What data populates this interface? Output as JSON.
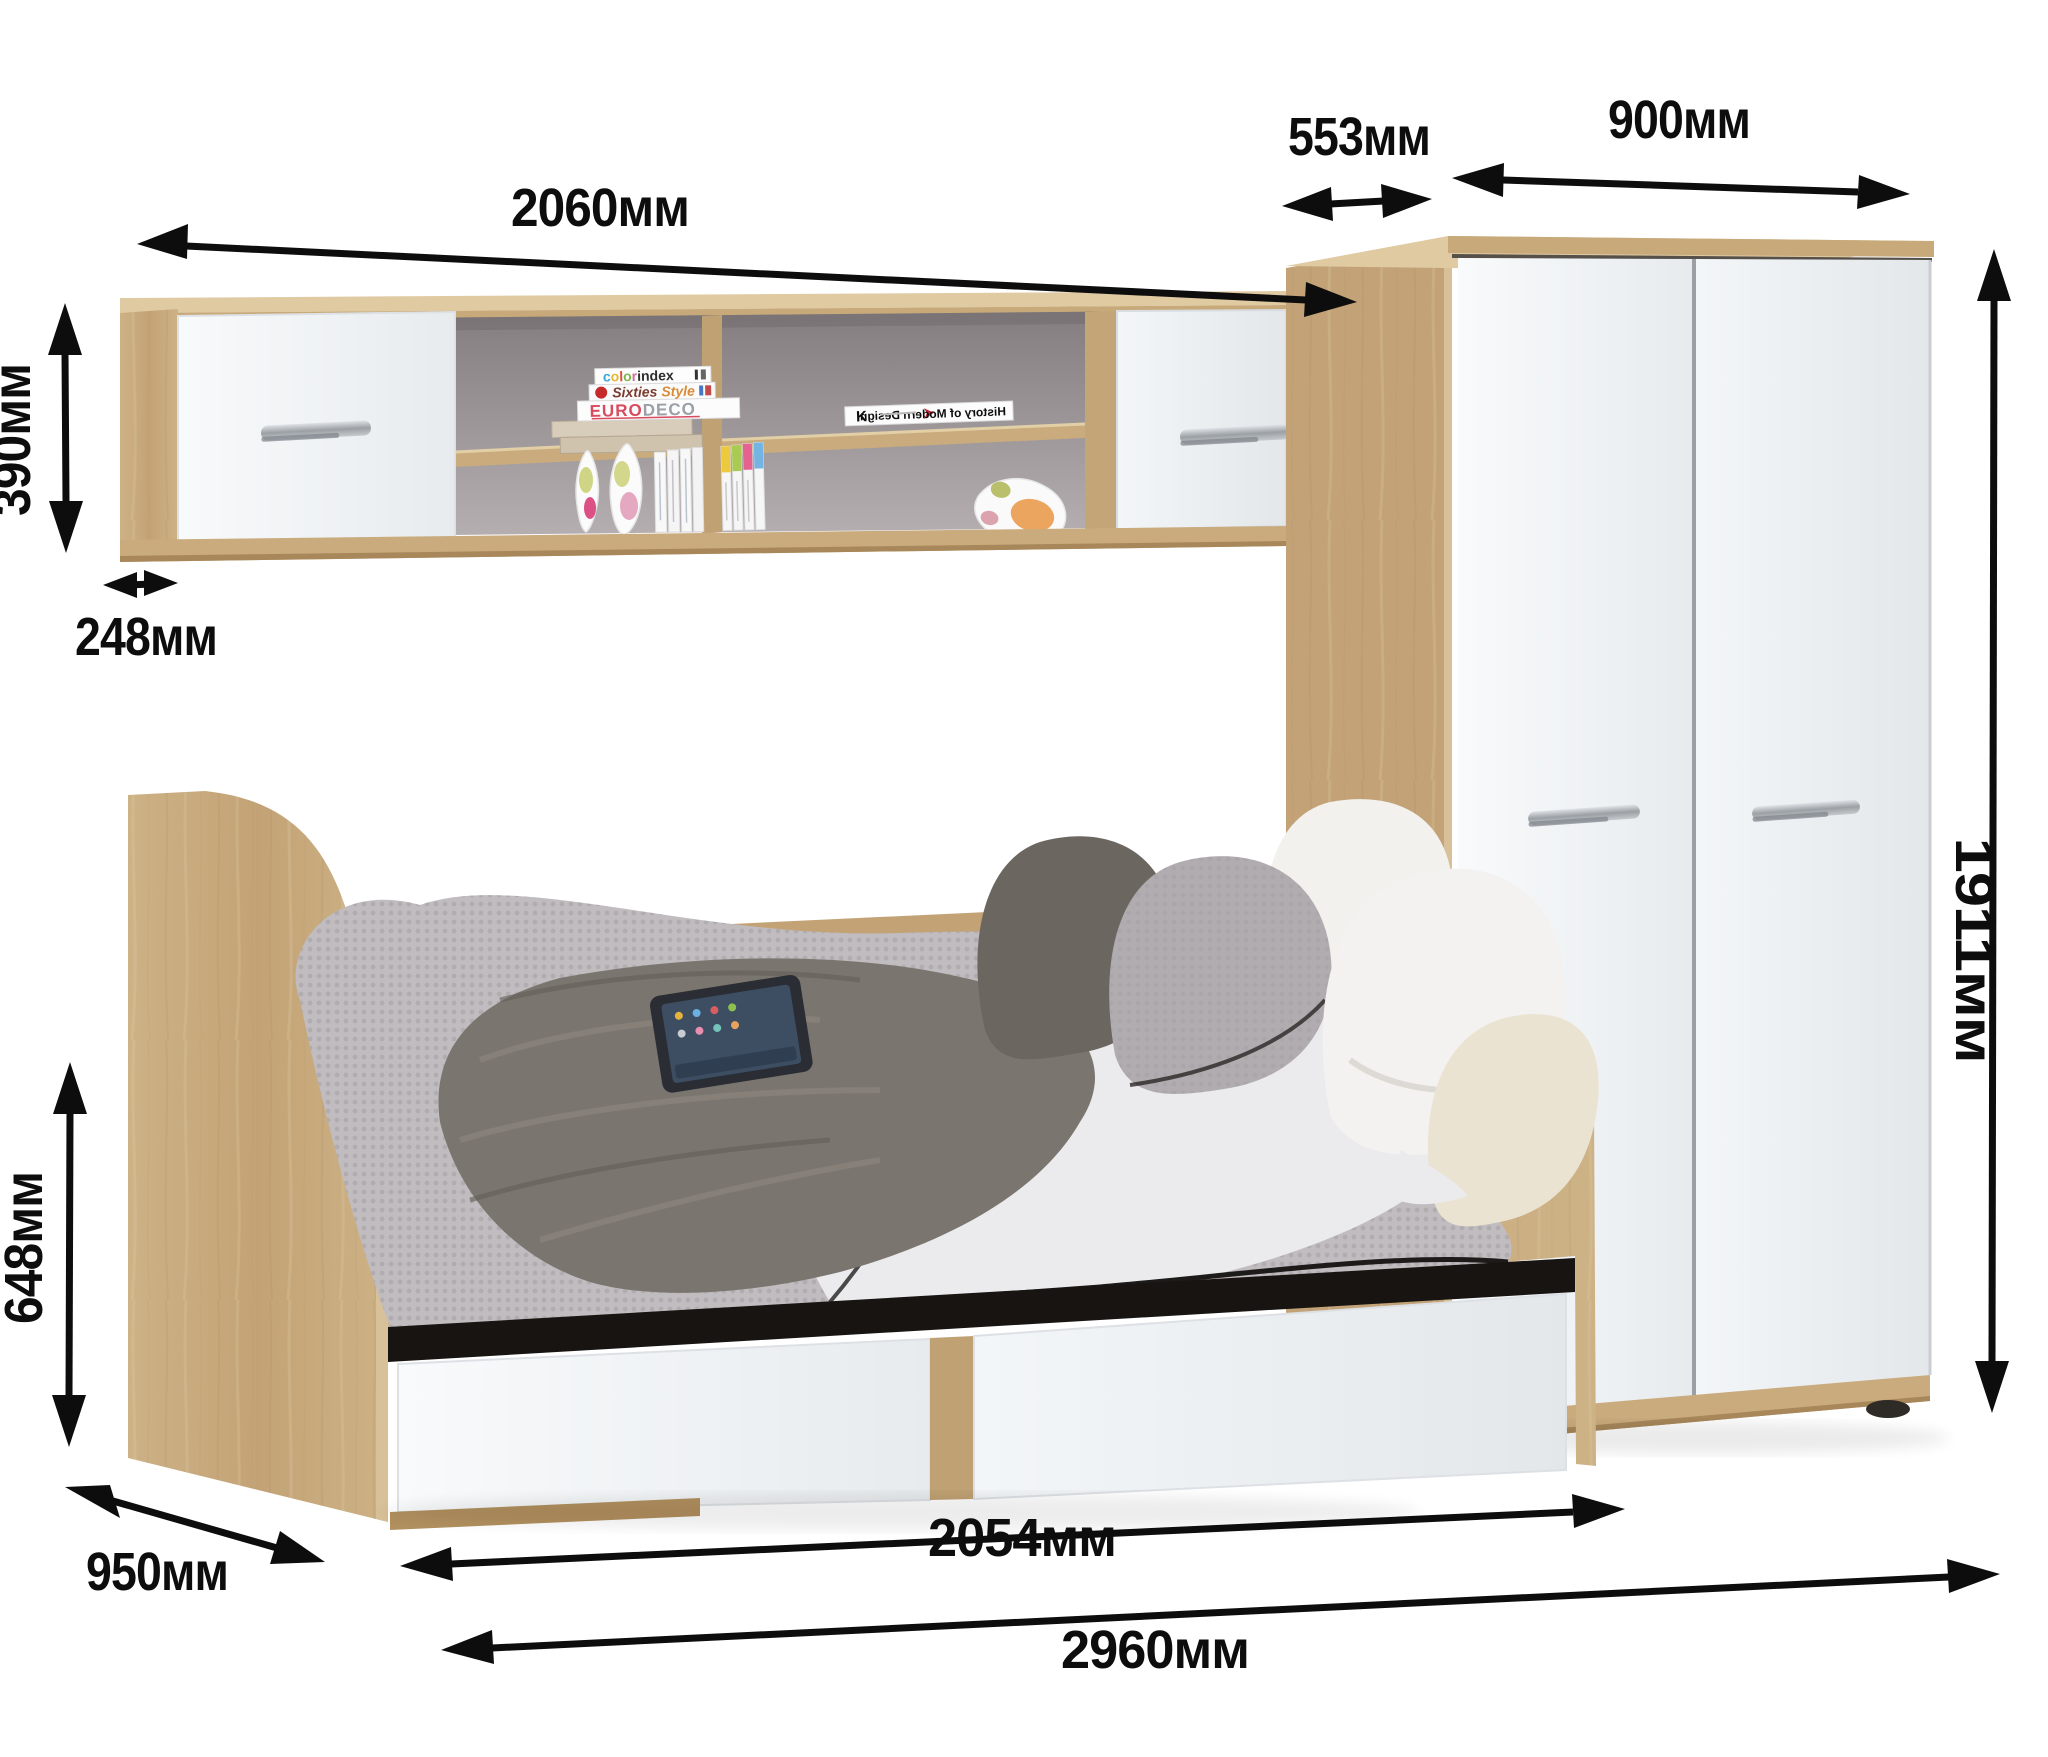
{
  "dimensions": {
    "shelf_width": "2060мм",
    "wardrobe_depth": "553мм",
    "wardrobe_width": "900мм",
    "shelf_height": "390мм",
    "shelf_depth": "248мм",
    "wardrobe_height": "1911мм",
    "bed_height": "648мм",
    "bed_depth": "950мм",
    "bed_length": "2054мм",
    "total_width": "2960мм"
  },
  "decor": {
    "book_colorindex": {
      "c": "c",
      "o1": "o",
      "l": "l",
      "o2": "o",
      "r": "r",
      "rest": "index"
    },
    "book_sixties": {
      "word1": "Sixties",
      "word2": "Style"
    },
    "book_eurodeco": {
      "euro": "EURO",
      "deco": "DECO"
    },
    "book_history": {
      "letter": "K",
      "title": "History of Modern Design"
    }
  },
  "colors": {
    "wood": "#c9ab7d",
    "wood_light": "#dcc49a",
    "wood_dark": "#b2905f",
    "door_white": "#f2f4f6",
    "interior_back": "#8e8789",
    "arrow": "#0d0d0d",
    "handle_metal": "#9ba0a5",
    "blanket_grey": "#bfbabd",
    "throw_grey": "#7b756f",
    "pillow_cream": "#ece4d2"
  }
}
